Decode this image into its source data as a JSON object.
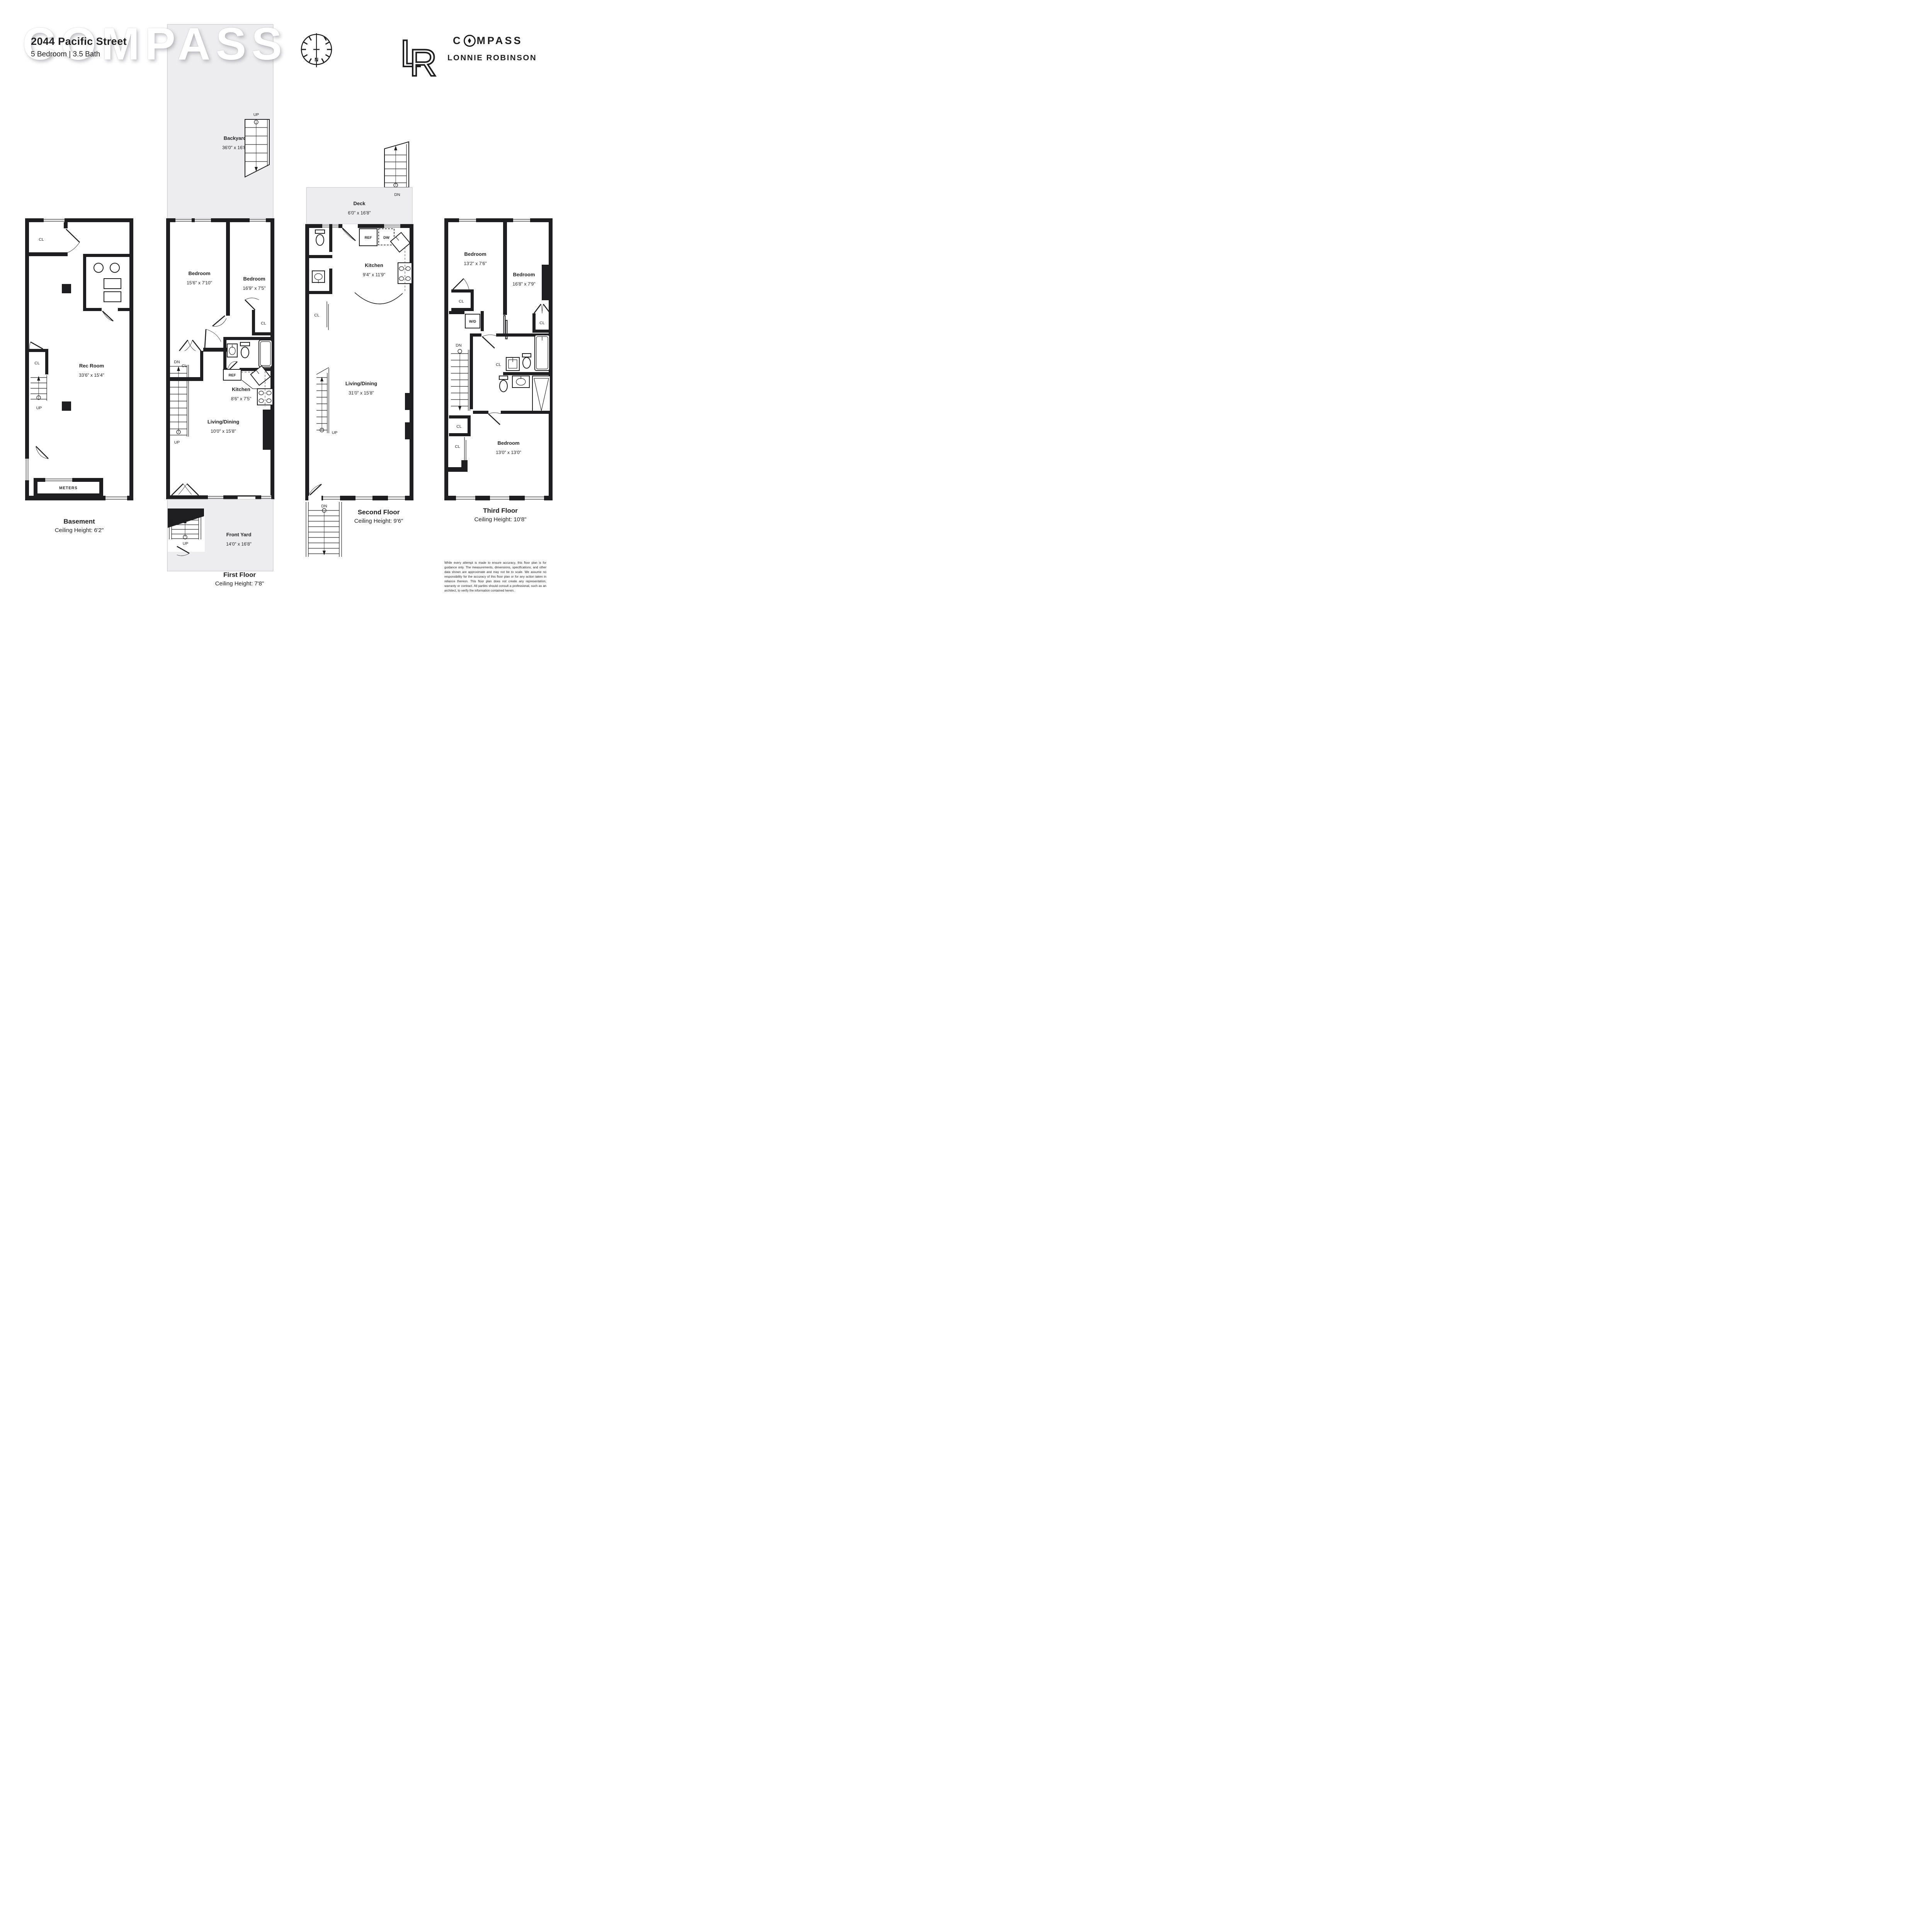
{
  "watermark": "COMPASS",
  "header": {
    "address": "2044 Pacific Street",
    "specs": "5 Bedroom | 3.5 Bath"
  },
  "brand": {
    "wordmark_c": "C",
    "wordmark_rest": "MPASS",
    "agent": "LONNIE ROBINSON",
    "monogram_l": "L",
    "monogram_r": "R"
  },
  "rose": {
    "north": "N"
  },
  "labels": {
    "up": "UP",
    "dn": "DN",
    "cl": "CL",
    "ref": "REF",
    "dw": "DW",
    "wd": "W/D",
    "meters": "METERS"
  },
  "floors": {
    "basement": {
      "title": "Basement",
      "ceiling": "Ceiling Height: 6'2\"",
      "rec_room": {
        "name": "Rec Room",
        "dims": "33'6\" x 15'4\""
      }
    },
    "first": {
      "title": "First Floor",
      "ceiling": "Ceiling Height: 7'8\"",
      "backyard": {
        "name": "Backyard",
        "dims": "36'0\" x 16'8\""
      },
      "bedroom1": {
        "name": "Bedroom",
        "dims": "15'6\" x 7'10\""
      },
      "bedroom2": {
        "name": "Bedroom",
        "dims": "16'9\" x 7'5\""
      },
      "kitchen": {
        "name": "Kitchen",
        "dims": "8'6\" x 7'5\""
      },
      "living": {
        "name": "Living/Dining",
        "dims": "10'0\" x 15'8\""
      },
      "frontyard": {
        "name": "Front Yard",
        "dims": "14'0\" x 16'8\""
      }
    },
    "second": {
      "title": "Second Floor",
      "ceiling": "Ceiling Height: 9'6\"",
      "deck": {
        "name": "Deck",
        "dims": "6'0\" x 16'8\""
      },
      "kitchen": {
        "name": "Kitchen",
        "dims": "9'4\" x 11'9\""
      },
      "living": {
        "name": "Living/Dining",
        "dims": "31'0\" x 15'8\""
      }
    },
    "third": {
      "title": "Third Floor",
      "ceiling": "Ceiling Height: 10'8\"",
      "bedroom1": {
        "name": "Bedroom",
        "dims": "13'2\" x 7'6\""
      },
      "bedroom2": {
        "name": "Bedroom",
        "dims": "16'8\" x 7'9\""
      },
      "bedroom3": {
        "name": "Bedroom",
        "dims": "13'0\" x 13'0\""
      }
    }
  },
  "disclaimer": "While every attempt is made to ensure accuracy, this floor plan is for guidance only. The measurements, dimensions, specifications, and other data shown are approximate and may not be to scale. We assume no responsibility for the accuracy of this floor plan or for any action taken in reliance thereon. This floor plan does not create any representation, warranty or contract. All parties should consult a professional, such as an architect, to verify the information contained herein."
}
